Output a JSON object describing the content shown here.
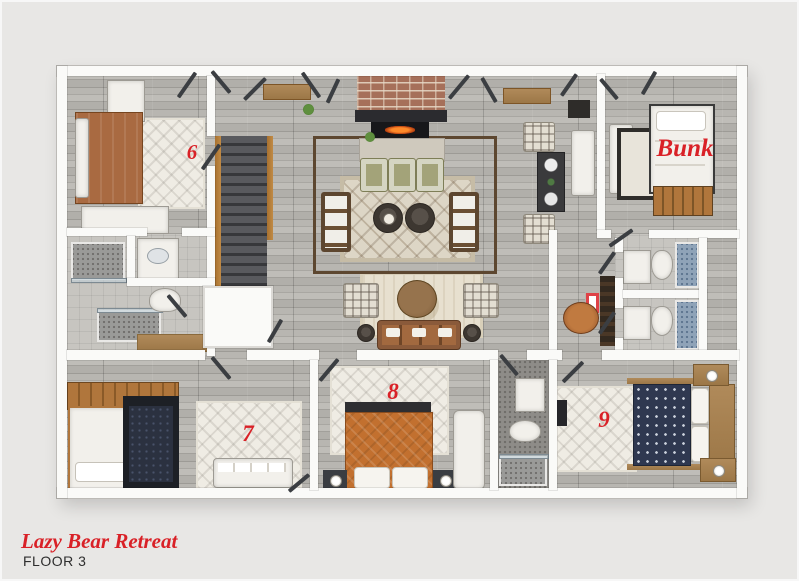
{
  "plan": {
    "title": "Lazy Bear Retreat",
    "floor_label": "FLOOR 3"
  },
  "labels": {
    "bedroom6": "6",
    "bunk_room": "Bunk",
    "bedroom7": "7",
    "bedroom8": "8",
    "bedroom9": "9"
  },
  "colors": {
    "background": "#e8e7e5",
    "walls": "#fafaf8",
    "floor_wood_gray": "#b2b0ab",
    "label_red": "#d92127",
    "bed6_brown": "#a96a41",
    "bed8_orange": "#c2702f",
    "bed9_navy": "#2f3850",
    "bunk_ladder_wood": "#b0763c",
    "shower_tile_blue": "#8fa3b8",
    "shower_tile_gray": "#9a9a98"
  },
  "areas": {
    "bedroom6": {
      "furniture": [
        "double-bed",
        "rug",
        "dresser",
        "bench"
      ]
    },
    "living_room": {
      "furniture": [
        "fireplace",
        "area-rug",
        "sofa",
        "sofa",
        "accent-chair",
        "accent-chair",
        "accent-chair",
        "ottoman",
        "ottoman",
        "console"
      ]
    },
    "dining_nook": {
      "furniture": [
        "table",
        "plaid-chair",
        "plaid-chair",
        "bench"
      ]
    },
    "bunk_room": {
      "furniture": [
        "bunk-bed",
        "ladder",
        "sofa",
        "desk"
      ]
    },
    "sitting_area": {
      "furniture": [
        "leather-sofa",
        "round-table",
        "plaid-chair",
        "plaid-chair",
        "rug"
      ]
    },
    "bath_left": {
      "furniture": [
        "shower",
        "vanity",
        "toilet",
        "shower"
      ]
    },
    "baths_right": {
      "furniture": [
        "vanity",
        "toilet",
        "shower",
        "vanity",
        "toilet",
        "shower"
      ]
    },
    "hall": {
      "furniture": [
        "staircase",
        "bench",
        "closet",
        "desk",
        "office-chair"
      ]
    },
    "bedroom7": {
      "furniture": [
        "twin-bed-white",
        "twin-bed-dark",
        "rug",
        "sofa"
      ]
    },
    "bedroom8": {
      "furniture": [
        "queen-bed",
        "rug",
        "nightstand",
        "nightstand",
        "chaise"
      ]
    },
    "bath_small": {
      "furniture": [
        "sink",
        "toilet",
        "shower"
      ]
    },
    "bedroom9": {
      "furniture": [
        "queen-bed",
        "rug",
        "nightstand",
        "nightstand"
      ]
    }
  }
}
